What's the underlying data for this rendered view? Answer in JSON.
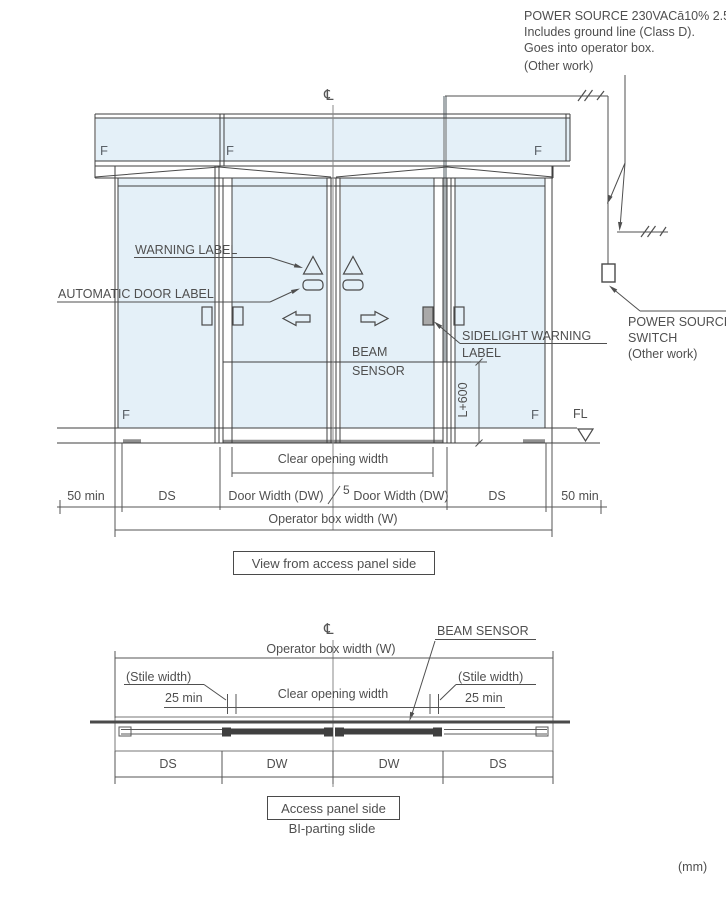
{
  "units_note": "(mm)",
  "colors": {
    "glass": "#e4f0f8",
    "structure_line": "#3f3f3f",
    "dimension_line": "#555555",
    "text": "#4f4f4f",
    "conduit_gray": "#a7adb0"
  },
  "power_note": {
    "line1": "POWER SOURCE 230VACā10% 2.5A",
    "line2": "Includes ground line (Class D).",
    "line3": "Goes into operator box.",
    "line4": "(Other work)"
  },
  "power_switch": {
    "line1": "POWER SOURCE",
    "line2": "SWITCH",
    "line3": "(Other work)"
  },
  "elevation": {
    "centerline_symbol": "℄",
    "f_top_left": "F",
    "f_top_mid": "F",
    "f_top_right": "F",
    "f_bottom_left": "F",
    "f_bottom_right": "F",
    "floor_level": "FL",
    "warning_label": "WARNING LABEL",
    "automatic_door_label": "AUTOMATIC DOOR LABEL",
    "sidelight_warning_line1": "SIDELIGHT WARNING",
    "sidelight_warning_line2": "LABEL",
    "beam_sensor_line1": "BEAM",
    "beam_sensor_line2": "SENSOR",
    "beam_height": "L+600",
    "dims": {
      "clear_opening": "Clear opening width",
      "fifty_min_left": "50 min",
      "ds_left": "DS",
      "door_width_left": "Door Width (DW)",
      "center_gap": "5",
      "door_width_right": "Door Width (DW)",
      "ds_right": "DS",
      "fifty_min_right": "50 min",
      "operator_box_width": "Operator box width (W)"
    },
    "caption": "View from access panel side"
  },
  "plan": {
    "centerline_symbol": "℄",
    "beam_sensor": "BEAM SENSOR",
    "operator_box_width": "Operator box width (W)",
    "stile_width_left": "(Stile width)",
    "stile_width_right": "(Stile width)",
    "stile_min_left": "25 min",
    "stile_min_right": "25 min",
    "clear_opening": "Clear opening width",
    "ds_left": "DS",
    "dw_left": "DW",
    "dw_right": "DW",
    "ds_right": "DS",
    "caption": "Access panel side",
    "subcaption": "BI-parting slide"
  }
}
